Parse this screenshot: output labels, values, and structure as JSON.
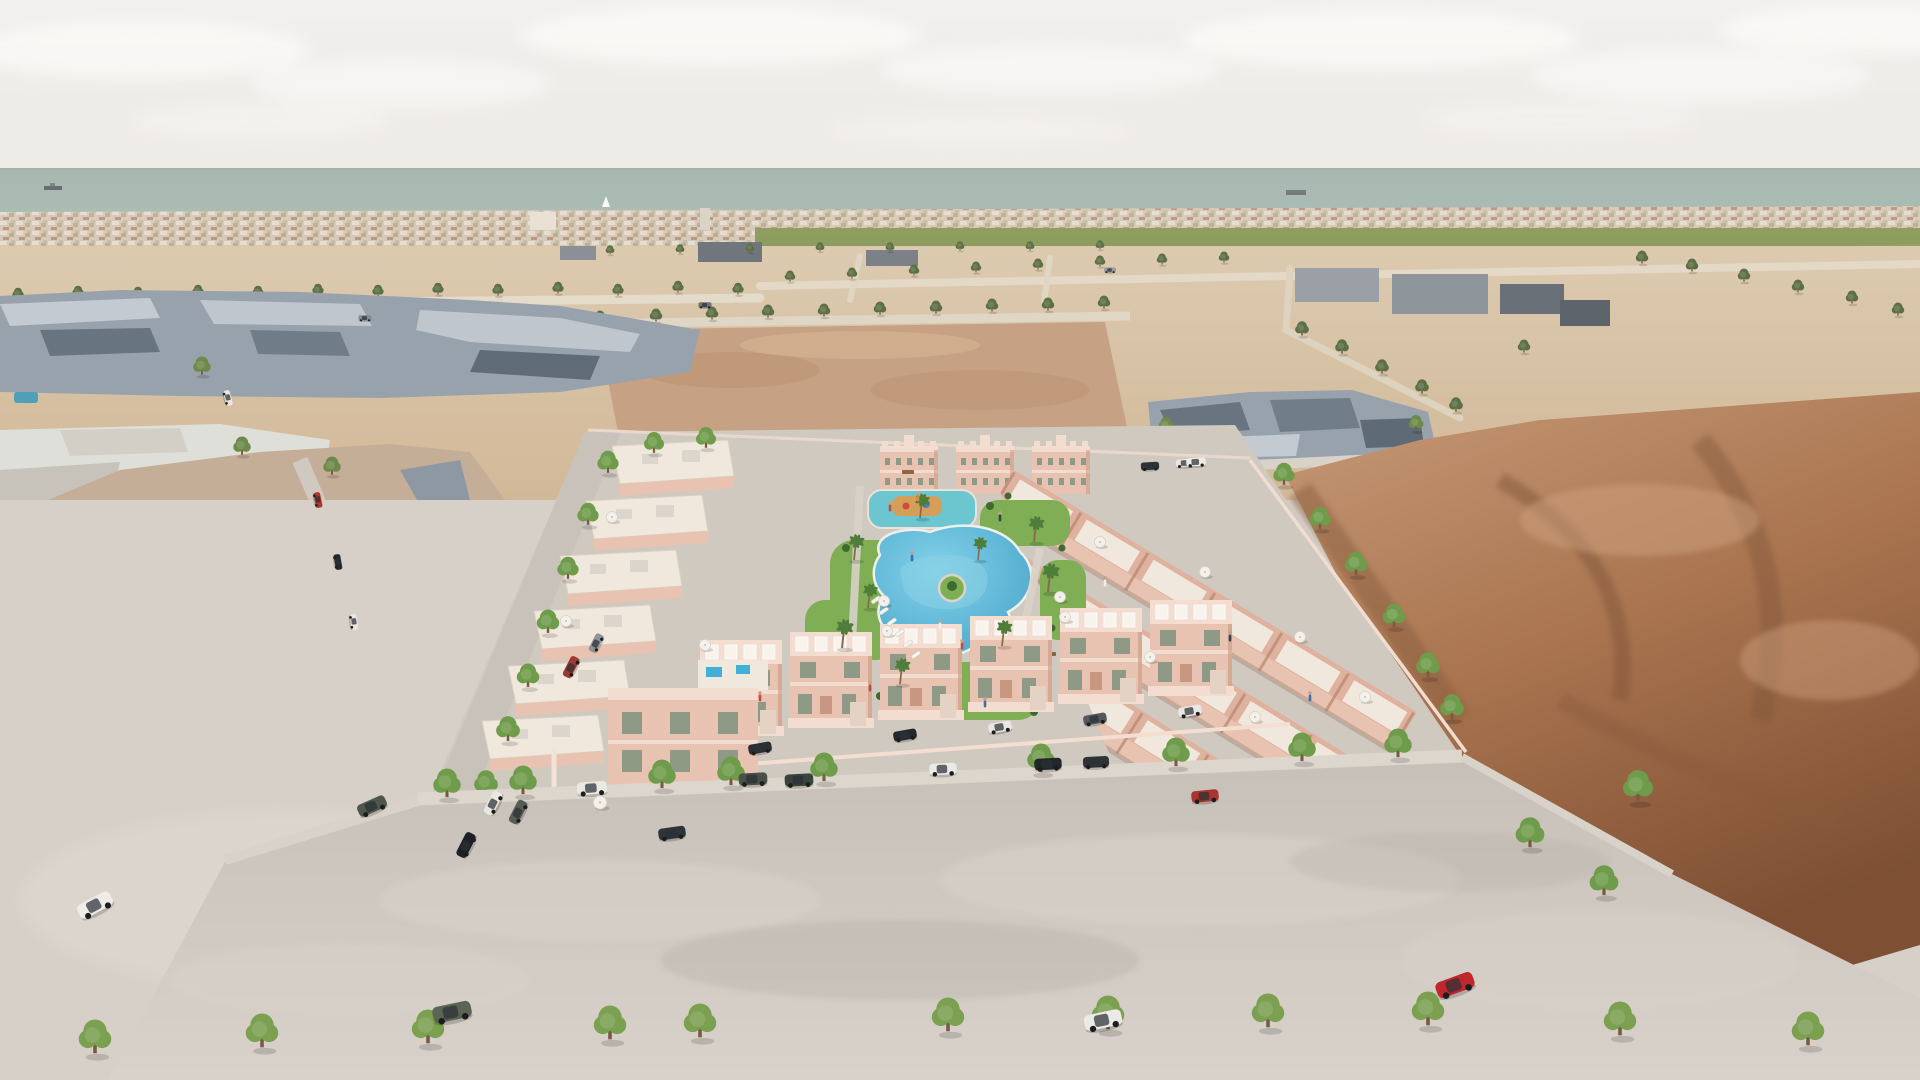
{
  "scene": {
    "type": "aerial-architectural-rendering",
    "subject": "new residential development of pink townhouses and apartment blocks around a landscaped lagoon pool",
    "surroundings": [
      "low-poly existing town on the left",
      "vacant desert plots",
      "brown dirt field on the right",
      "sea on the horizon",
      "street with parked cars in the foreground"
    ],
    "conditions": "hazy daylight"
  },
  "palette": {
    "sky_top": "#e4e2df",
    "sky_low": "#edeae5",
    "cloud": "#f6f4f1",
    "sea": "#a7bab1",
    "sea_deep": "#9cafa6",
    "city": "#d5c9b6",
    "city_light": "#e8e0d2",
    "city_roof": "#b98b74",
    "orchard": "#75894f",
    "orchard_light": "#8b9c5c",
    "sand": "#dccab0",
    "sand_deep": "#d0b593",
    "dirt_lot": "#c6a183",
    "dirt": "#a9744f",
    "dirt_dark": "#7e4f33",
    "dirt_light": "#c79a78",
    "slate": "#98a2ac",
    "slate_dark": "#68747f",
    "slate_light": "#c3cad1",
    "tan": "#c5ae97",
    "tan_dark": "#ab9179",
    "tan_light": "#d9cab6",
    "white_bldg": "#dfdfda",
    "pool": "#3fb0d8",
    "pool_light": "#83d2ea",
    "kids_pool": "#6cc6cf",
    "lawn": "#7fae54",
    "shrub": "#3f6b33",
    "pink": "#e9c3b1",
    "pink_light": "#f3ddd0",
    "pink_dark": "#c89781",
    "cream": "#f0e8dd",
    "window": "#8e9a86",
    "road": "#c6c0b9",
    "road_light": "#d8d2ca",
    "pavement": "#d6d0c8",
    "dev_ground": "#cfc9c0",
    "tree": "#6f9c4a",
    "tree_far": "#5c7044",
    "palm": "#4f7d3a",
    "trunk": "#7a5b40"
  },
  "landmarks": {
    "apartment_blocks": 3,
    "pools": [
      "kids splash pool with playground",
      "lagoon swimming pool",
      "rooftop plunge pools",
      "small pools in old town"
    ],
    "sculpture": "white bird sculpture on lawn",
    "boats": [
      "cargo ship far left",
      "sailboat centre",
      "cargo ship right"
    ]
  },
  "instances": [
    {
      "symbol": "sym-tree",
      "name": "tree-icon",
      "layer": "layer-mid-trees",
      "items": [
        [
          18,
          299,
          0.45
        ],
        [
          78,
          297,
          0.45
        ],
        [
          138,
          298,
          0.45
        ],
        [
          198,
          296,
          0.45
        ],
        [
          258,
          297,
          0.45
        ],
        [
          318,
          295,
          0.45
        ],
        [
          378,
          296,
          0.45
        ],
        [
          438,
          294,
          0.45
        ],
        [
          498,
          295,
          0.45
        ],
        [
          558,
          293,
          0.45
        ],
        [
          618,
          295,
          0.45
        ],
        [
          678,
          292,
          0.45
        ],
        [
          738,
          294,
          0.45
        ],
        [
          610,
          254,
          0.35
        ],
        [
          680,
          253,
          0.35
        ],
        [
          750,
          252,
          0.35
        ],
        [
          820,
          251,
          0.35
        ],
        [
          890,
          251,
          0.35
        ],
        [
          960,
          250,
          0.35
        ],
        [
          1030,
          250,
          0.35
        ],
        [
          1100,
          249,
          0.35
        ],
        [
          790,
          281,
          0.42
        ],
        [
          852,
          278,
          0.42
        ],
        [
          914,
          275,
          0.42
        ],
        [
          976,
          272,
          0.42
        ],
        [
          1038,
          269,
          0.42
        ],
        [
          1100,
          266,
          0.42
        ],
        [
          1162,
          264,
          0.42
        ],
        [
          1224,
          262,
          0.42
        ],
        [
          600,
          323,
          0.5
        ],
        [
          656,
          321,
          0.5
        ],
        [
          712,
          319,
          0.5
        ],
        [
          768,
          317,
          0.5
        ],
        [
          824,
          316,
          0.5
        ],
        [
          880,
          314,
          0.5
        ],
        [
          936,
          313,
          0.5
        ],
        [
          992,
          311,
          0.5
        ],
        [
          1048,
          310,
          0.5
        ],
        [
          1104,
          308,
          0.5
        ],
        [
          1642,
          263,
          0.5
        ],
        [
          1692,
          271,
          0.5
        ],
        [
          1744,
          281,
          0.5
        ],
        [
          1798,
          292,
          0.5
        ],
        [
          1852,
          303,
          0.5
        ],
        [
          1898,
          315,
          0.5
        ],
        [
          1302,
          335,
          0.55
        ],
        [
          1342,
          353,
          0.55
        ],
        [
          1382,
          373,
          0.55
        ],
        [
          1422,
          393,
          0.55
        ],
        [
          1456,
          411,
          0.55
        ],
        [
          132,
          341,
          0.5
        ],
        [
          422,
          351,
          0.5
        ],
        [
          524,
          336,
          0.5
        ],
        [
          1524,
          352,
          0.5
        ],
        [
          96,
          316,
          0.5
        ]
      ]
    },
    {
      "symbol": "sym-tree",
      "name": "tree-icon",
      "layer": "layer-town-trees",
      "items": [
        [
          202,
          374,
          0.7
        ],
        [
          242,
          454,
          0.7
        ],
        [
          332,
          474,
          0.7
        ],
        [
          92,
          522,
          0.7
        ],
        [
          258,
          548,
          0.7
        ],
        [
          412,
          522,
          0.7
        ],
        [
          152,
          588,
          0.75
        ],
        [
          362,
          612,
          0.75
        ],
        [
          300,
          660,
          0.75
        ],
        [
          240,
          700,
          0.8
        ],
        [
          444,
          656,
          0.75
        ],
        [
          1166,
          432,
          0.6
        ],
        [
          1232,
          454,
          0.6
        ],
        [
          1416,
          430,
          0.6
        ]
      ]
    },
    {
      "symbol": "sym-tree",
      "name": "tree-icon",
      "layer": "layer-dev-trees",
      "items": [
        [
          608,
          472,
          0.85
        ],
        [
          588,
          524,
          0.85
        ],
        [
          568,
          578,
          0.85
        ],
        [
          548,
          632,
          0.9
        ],
        [
          528,
          686,
          0.9
        ],
        [
          508,
          740,
          0.95
        ],
        [
          486,
          794,
          0.95
        ],
        [
          452,
          846,
          1.0
        ],
        [
          654,
          452,
          0.8
        ],
        [
          706,
          447,
          0.8
        ],
        [
          1284,
          484,
          0.85
        ],
        [
          1320,
          528,
          0.85
        ],
        [
          1356,
          574,
          0.9
        ],
        [
          1394,
          626,
          0.9
        ],
        [
          1428,
          676,
          0.95
        ],
        [
          1452,
          718,
          0.95
        ]
      ]
    },
    {
      "symbol": "sym-tree",
      "name": "street-tree-icon",
      "layer": "layer-street-trees",
      "items": [
        [
          447,
          796,
          1.1
        ],
        [
          523,
          793,
          1.1
        ],
        [
          662,
          787,
          1.1
        ],
        [
          731,
          784,
          1.1
        ],
        [
          824,
          780,
          1.1
        ],
        [
          1041,
          771,
          1.1
        ],
        [
          1176,
          765,
          1.1
        ],
        [
          1302,
          760,
          1.1
        ],
        [
          1398,
          756,
          1.1
        ],
        [
          1530,
          846,
          1.15
        ],
        [
          1604,
          894,
          1.15
        ],
        [
          1638,
          800,
          1.2
        ]
      ]
    },
    {
      "symbol": "sym-tree",
      "name": "sapling-icon",
      "layer": "layer-saplings",
      "items": [
        [
          95,
          1052,
          1.3
        ],
        [
          262,
          1046,
          1.3
        ],
        [
          428,
          1042,
          1.3
        ],
        [
          610,
          1038,
          1.3
        ],
        [
          700,
          1036,
          1.3
        ],
        [
          948,
          1030,
          1.3
        ],
        [
          1108,
          1028,
          1.3
        ],
        [
          1268,
          1026,
          1.3
        ],
        [
          1428,
          1024,
          1.3
        ],
        [
          1620,
          1034,
          1.3
        ],
        [
          1808,
          1044,
          1.3
        ]
      ]
    },
    {
      "symbol": "sym-palm",
      "name": "palm-tree-icon",
      "layer": "layer-palms",
      "items": [
        [
          854,
          560,
          0.9
        ],
        [
          842,
          648,
          1.0
        ],
        [
          900,
          684,
          0.9
        ],
        [
          1034,
          542,
          0.9
        ],
        [
          1048,
          592,
          1.0
        ],
        [
          920,
          518,
          0.85
        ],
        [
          1002,
          646,
          0.9
        ],
        [
          868,
          608,
          0.85
        ],
        [
          978,
          560,
          0.8
        ]
      ]
    },
    {
      "symbol": "sym-car",
      "name": "car",
      "layer": "layer-cars",
      "items": [
        [
          592,
          788,
          1.15,
          "#ebe8e3",
          -4
        ],
        [
          753,
          779,
          1.1,
          "#4a4f49",
          -3
        ],
        [
          799,
          780,
          1.1,
          "#39453a",
          -3
        ],
        [
          943,
          769,
          1.05,
          "#ebeae6",
          -3
        ],
        [
          1048,
          764,
          1.05,
          "#23262a",
          -3
        ],
        [
          1096,
          762,
          1.0,
          "#2e3337",
          -3
        ],
        [
          1205,
          796,
          1.05,
          "#a8352e",
          -6
        ],
        [
          372,
          806,
          1.15,
          "#4e5749",
          -24
        ],
        [
          1455,
          985,
          1.5,
          "#c0272d",
          -20
        ],
        [
          1103,
          1020,
          1.45,
          "#eceae6",
          -12
        ],
        [
          95,
          905,
          1.4,
          "#efece8",
          -28
        ],
        [
          452,
          1012,
          1.5,
          "#5c6553",
          -12
        ],
        [
          493,
          803,
          0.95,
          "#e9e7e2",
          -63
        ],
        [
          518,
          812,
          0.95,
          "#575d52",
          -63
        ],
        [
          466,
          845,
          1.0,
          "#1d2024",
          -63
        ],
        [
          571,
          667,
          0.85,
          "#9b3a30",
          -63
        ],
        [
          596,
          643,
          0.75,
          "#8d939a",
          -63
        ],
        [
          760,
          748,
          0.9,
          "#2b2f33",
          -10
        ],
        [
          905,
          735,
          0.9,
          "#24282c",
          -10
        ],
        [
          1000,
          727,
          0.9,
          "#e9e7e3",
          -10
        ],
        [
          1095,
          719,
          0.9,
          "#53585e",
          -10
        ],
        [
          1190,
          711,
          0.9,
          "#e9e7e3",
          -10
        ],
        [
          672,
          833,
          1.05,
          "#2f3437",
          -8
        ],
        [
          1150,
          466,
          0.7,
          "#2e3338",
          -3
        ],
        [
          1185,
          463,
          0.7,
          "#e8e6e2",
          -3
        ],
        [
          1196,
          462,
          0.75,
          "#ecebe7",
          -3
        ],
        [
          318,
          500,
          0.6,
          "#b0342c",
          78
        ],
        [
          338,
          562,
          0.6,
          "#23282c",
          80
        ],
        [
          354,
          622,
          0.62,
          "#e8e6e1",
          82
        ],
        [
          228,
          398,
          0.6,
          "#e9e7e2",
          75
        ],
        [
          365,
          318,
          0.5,
          "#878c90",
          0
        ],
        [
          705,
          305,
          0.5,
          "#6e7378",
          0
        ],
        [
          1110,
          270,
          0.45,
          "#96999d",
          0
        ]
      ]
    },
    {
      "symbol": "sym-umbrella",
      "name": "parasol-icon",
      "layer": "layer-umbrellas",
      "items": [
        [
          612,
          520,
          1
        ],
        [
          566,
          624,
          1
        ],
        [
          705,
          648,
          1
        ],
        [
          887,
          634,
          1
        ],
        [
          1065,
          620,
          1
        ],
        [
          1100,
          545,
          1
        ],
        [
          1205,
          575,
          1
        ],
        [
          1300,
          640,
          1
        ],
        [
          1365,
          700,
          1
        ],
        [
          1060,
          600,
          1
        ],
        [
          1150,
          660,
          1
        ],
        [
          1255,
          720,
          1
        ],
        [
          600,
          806,
          1.2
        ],
        [
          884,
          604,
          1
        ]
      ]
    },
    {
      "symbol": "sym-lounger",
      "name": "sun-lounger",
      "layer": "layer-loungers",
      "items": [
        [
          876,
          600,
          1,
          "",
          -35
        ],
        [
          884,
          611,
          1,
          "",
          -35
        ],
        [
          892,
          622,
          1,
          "",
          -35
        ],
        [
          900,
          633,
          1,
          "",
          -35
        ],
        [
          908,
          644,
          1,
          "",
          -35
        ],
        [
          916,
          655,
          1,
          "",
          -35
        ]
      ]
    },
    {
      "symbol": "sym-person",
      "name": "person",
      "layer": "layer-people",
      "items": [
        [
          940,
          628,
          1,
          "#f1efe9"
        ],
        [
          962,
          648,
          1,
          "#c14b3e"
        ],
        [
          912,
          560,
          1,
          "#3c6fb0"
        ],
        [
          890,
          510,
          1,
          "#c14b3e"
        ],
        [
          1000,
          520,
          1,
          "#33424e"
        ],
        [
          985,
          706,
          1,
          "#3c6fb0"
        ],
        [
          760,
          700,
          1,
          "#c14b3e"
        ],
        [
          1105,
          585,
          1,
          "#f1efe9"
        ],
        [
          1230,
          640,
          1,
          "#33424e"
        ],
        [
          870,
          690,
          1,
          "#c14b3e"
        ],
        [
          1310,
          700,
          1,
          "#3c6fb0"
        ],
        [
          918,
          500,
          1,
          "#e0883a"
        ]
      ]
    }
  ]
}
